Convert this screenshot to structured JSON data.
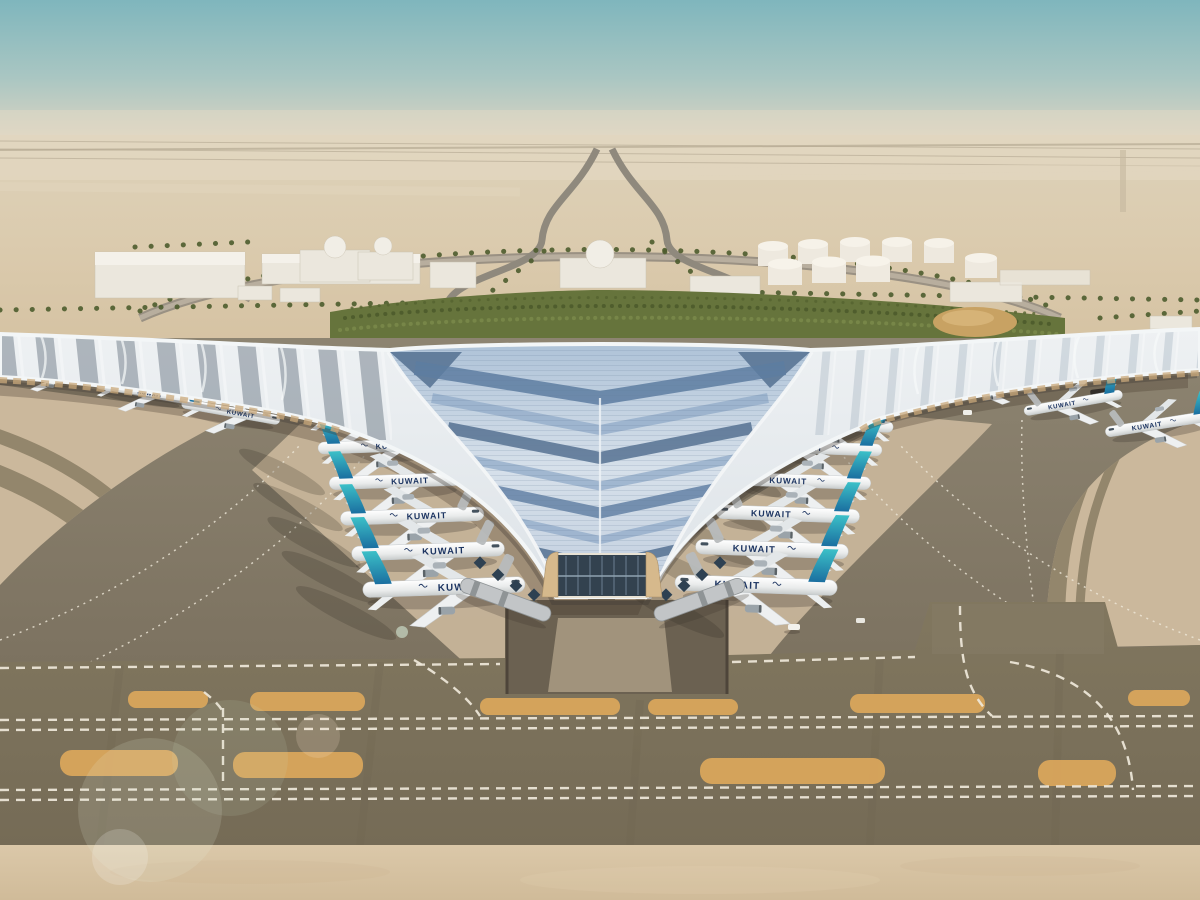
{
  "airline": {
    "title": "KUWAIT"
  },
  "scene": {
    "type": "aerial-architectural-rendering",
    "subject": "Desert airport terminal with swooping trefoil roof",
    "aircraft_visible": 20,
    "aircraft_livery": "white fuselage, navy KUWAIT titles, teal-to-blue gradient tail",
    "roof": "silver ribbed canopy with slate-blue glazing chevrons and white rim",
    "ground": "dark asphalt aprons, tan stands, dashed white taxiway centerlines, orange islands",
    "background": "desert horizon, white warehouses and domes, fuel tank farm, palm-lined approach roads, green landscaped band"
  },
  "palette": {
    "sky-top": "#7fb6bd",
    "sky-horizon": "#ded5c2",
    "desert-sand": "#dbcdb2",
    "apron-tan": "#cbb89c",
    "apron-dark": "#847a67",
    "taxiway-band": "#7e745f",
    "island-orange": "#d9a55c",
    "marking-white": "#efe8da",
    "bottom-sand": "#d8c5a6",
    "roof-silver": "#e9edf0",
    "roof-blue-light": "#93acc9",
    "roof-blue-mid": "#5d7ca1",
    "roof-blue-dark": "#44638a",
    "tail-teal": "#2fb3bf",
    "tail-deep": "#1b6fa0",
    "title-navy": "#1c3461",
    "fuselage-white": "#f4f5f4",
    "soffit-tan": "#c9a87b",
    "glass-dark": "#33424f",
    "palm-green": "#4d5c2d",
    "garden-green": "#66743c",
    "building-white": "#ebe7dd"
  }
}
